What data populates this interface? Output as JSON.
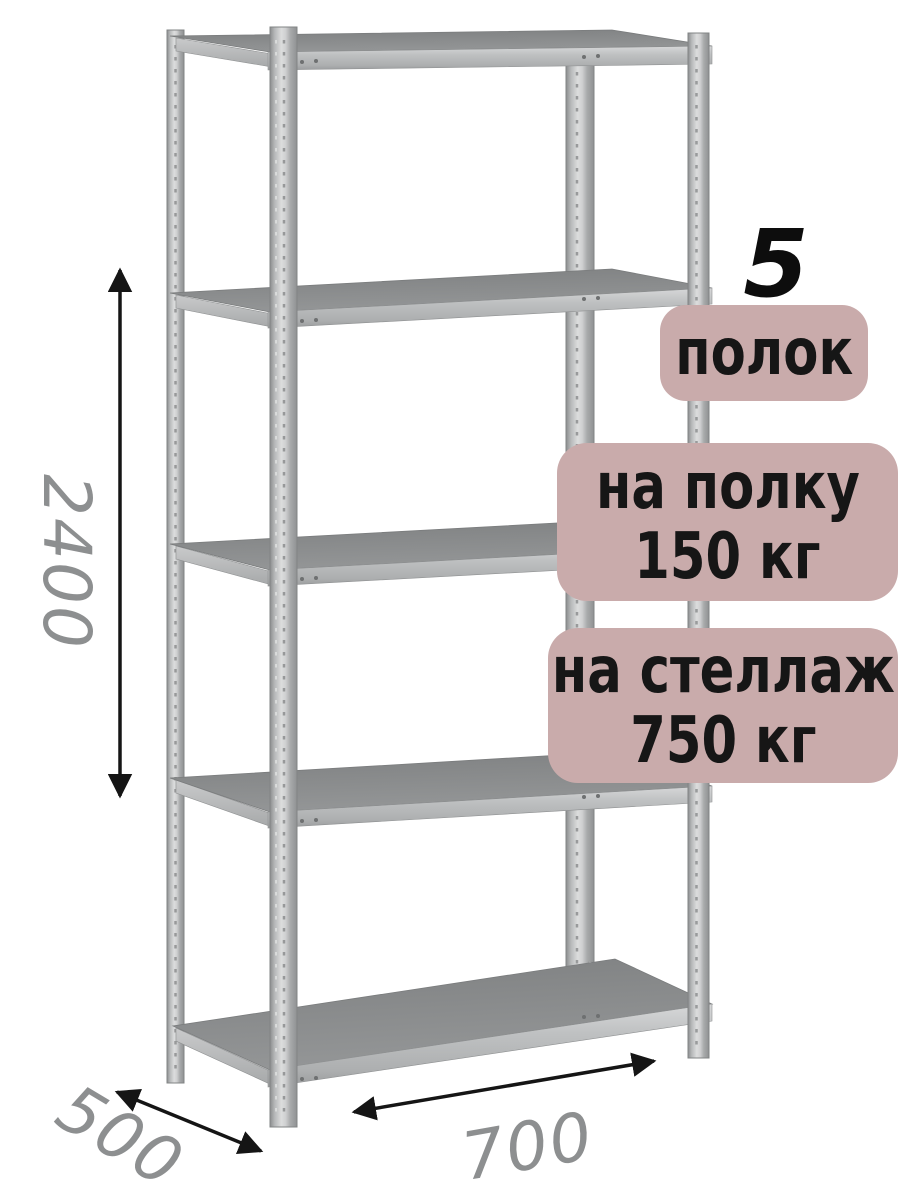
{
  "badges": {
    "shelf_count_number": "5",
    "shelf_count_label": "полок",
    "per_shelf_line1": "на полку",
    "per_shelf_line2": "150 кг",
    "per_rack_line1": "на стеллаж",
    "per_rack_line2": "750 кг"
  },
  "dimensions": {
    "height": "2400",
    "depth": "500",
    "width": "700"
  },
  "colors": {
    "badge_bg": "#c9abab",
    "badge_text": "#161616",
    "dimension_text": "#8d8f90",
    "arrow": "#151515",
    "metal_light": "#dcdddd",
    "metal_mid": "#aeb0b1",
    "shelf_surface": "#8e9091",
    "background": "#ffffff"
  }
}
